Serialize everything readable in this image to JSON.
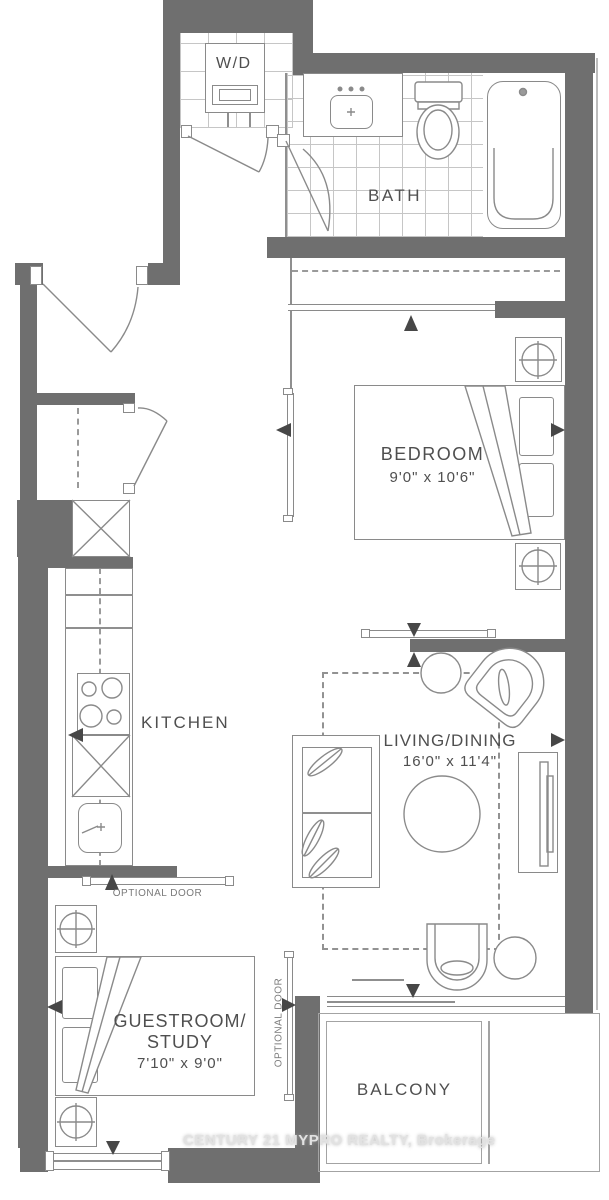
{
  "plan": {
    "rooms": {
      "wd": {
        "label": "W/D"
      },
      "bath": {
        "label": "BATH"
      },
      "bedroom": {
        "label": "BEDROOM",
        "dims": "9'0\" x 10'6\""
      },
      "kitchen": {
        "label": "KITCHEN"
      },
      "living": {
        "label": "LIVING/DINING",
        "dims": "16'0\" x 11'4\""
      },
      "guestroom": {
        "label1": "GUESTROOM/",
        "label2": "STUDY",
        "dims": "7'10\" x 9'0\""
      },
      "balcony": {
        "label": "BALCONY"
      }
    },
    "annotations": {
      "optional_door_top": "OPTIONAL DOOR",
      "optional_door_side": "OPTIONAL DOOR"
    },
    "watermark": "CENTURY 21 MYPRO REALTY, Brokerage",
    "colors": {
      "wall": "#6f6f6f",
      "line": "#8a8a8a",
      "label": "#4f4f4f",
      "tile": "#c6c6c6",
      "watermark": "#e2e2e2"
    }
  }
}
